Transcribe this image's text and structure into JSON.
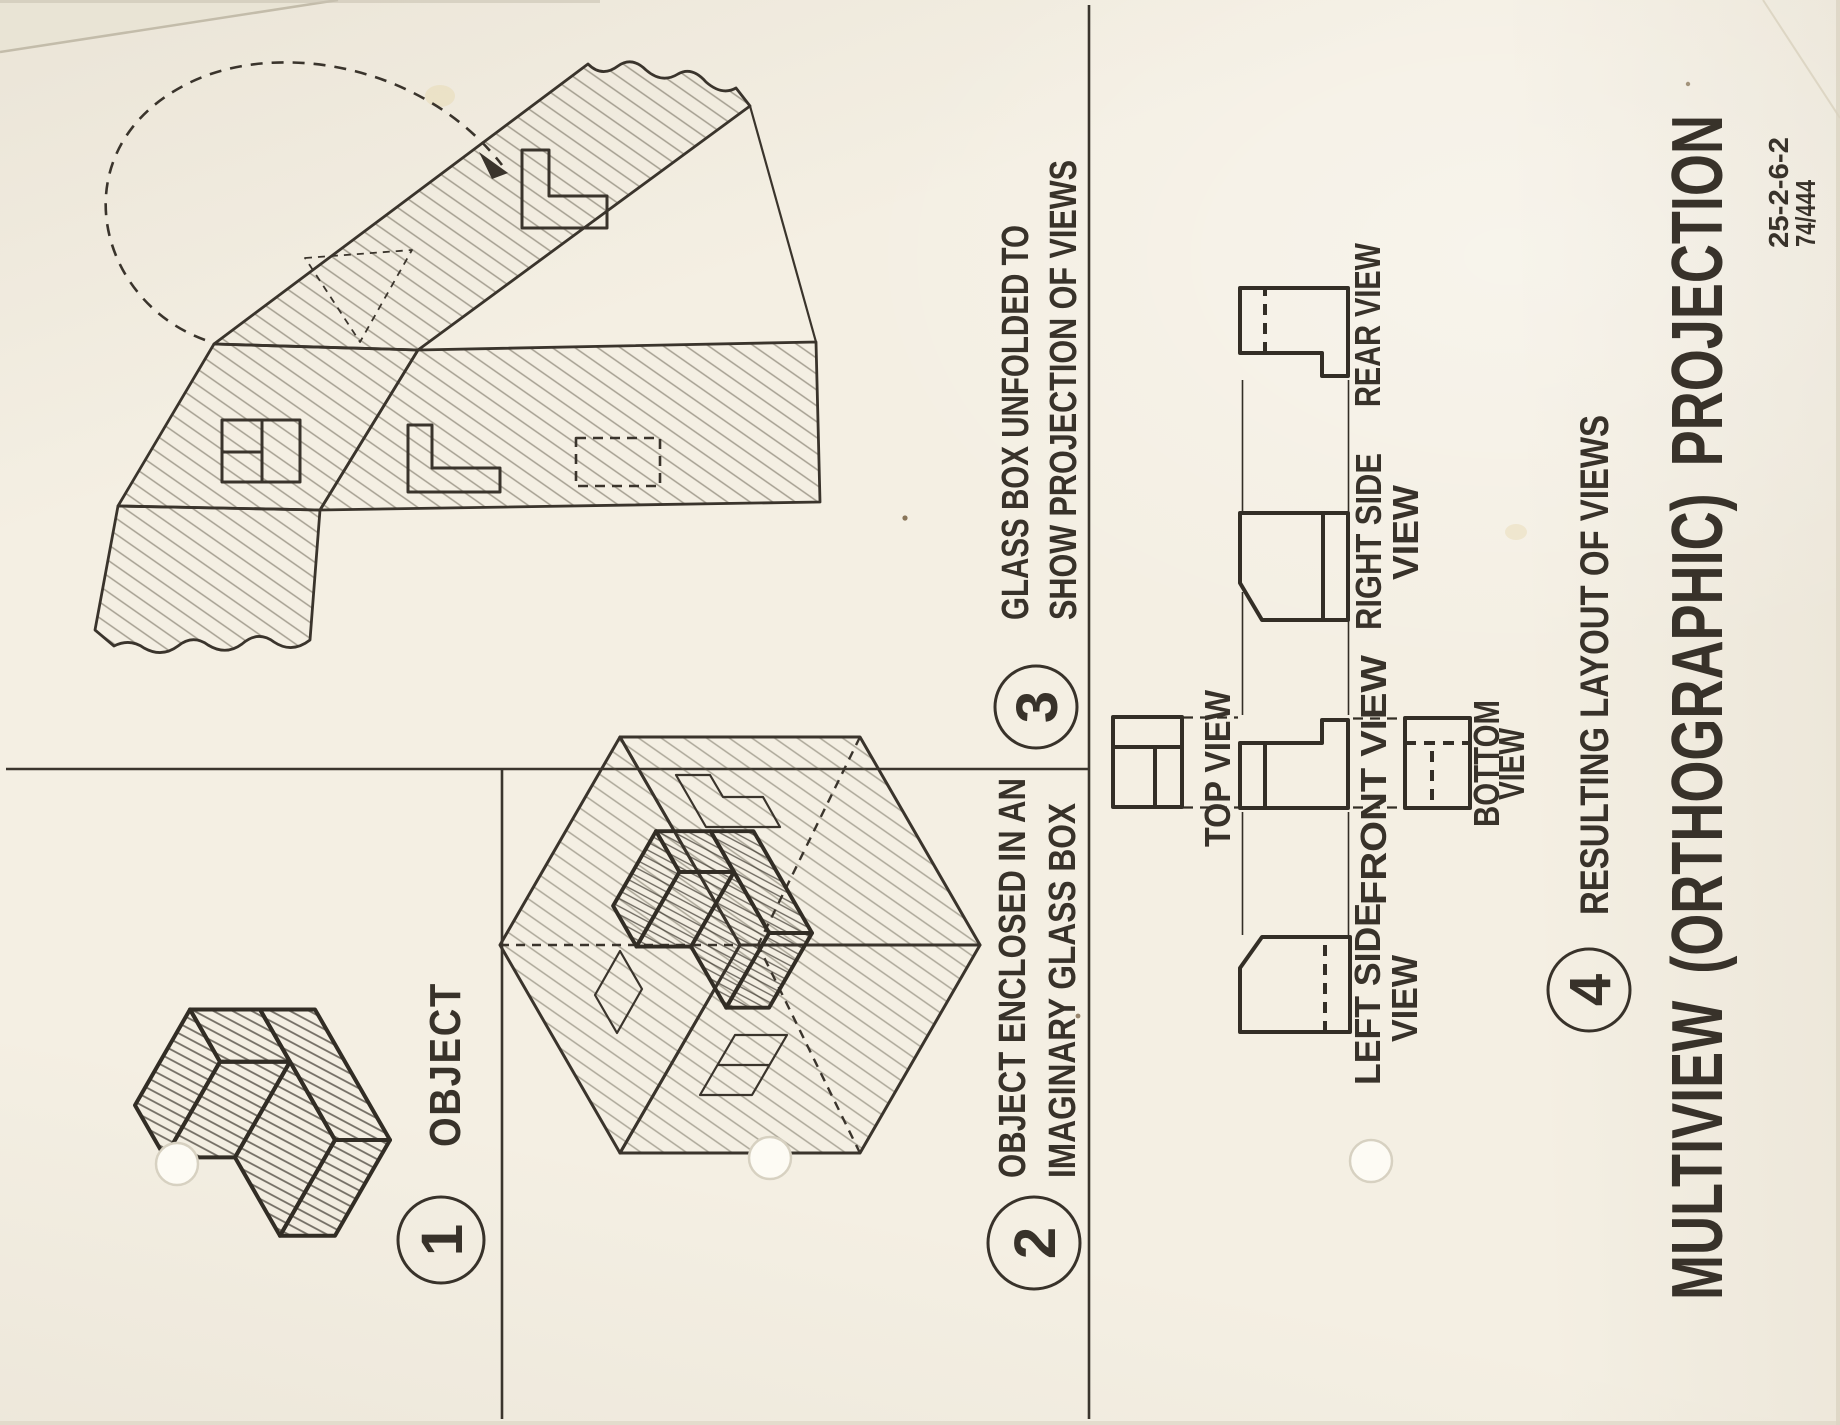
{
  "colors": {
    "paper": "#f4efe3",
    "ink": "#38322a"
  },
  "title": "MULTIVIEW (ORTHOGRAPHIC) PROJECTION",
  "doc_numbers": {
    "line1": "25-2-6-2",
    "line2": "74/444"
  },
  "steps": [
    {
      "number": "1",
      "lines": [
        "OBJECT"
      ]
    },
    {
      "number": "2",
      "lines": [
        "OBJECT ENCLOSED IN AN",
        "IMAGINARY GLASS BOX"
      ]
    },
    {
      "number": "3",
      "lines": [
        "GLASS BOX UNFOLDED TO",
        "SHOW PROJECTION OF VIEWS"
      ]
    },
    {
      "number": "4",
      "lines": [
        "RESULTING LAYOUT OF VIEWS"
      ]
    }
  ],
  "view_labels": {
    "top": "TOP VIEW",
    "front": "FRONT VIEW",
    "bottom": [
      "BOTTOM",
      "VIEW"
    ],
    "left": [
      "LEFT SIDE",
      "VIEW"
    ],
    "right": [
      "RIGHT SIDE",
      "VIEW"
    ],
    "rear": "REAR VIEW"
  }
}
